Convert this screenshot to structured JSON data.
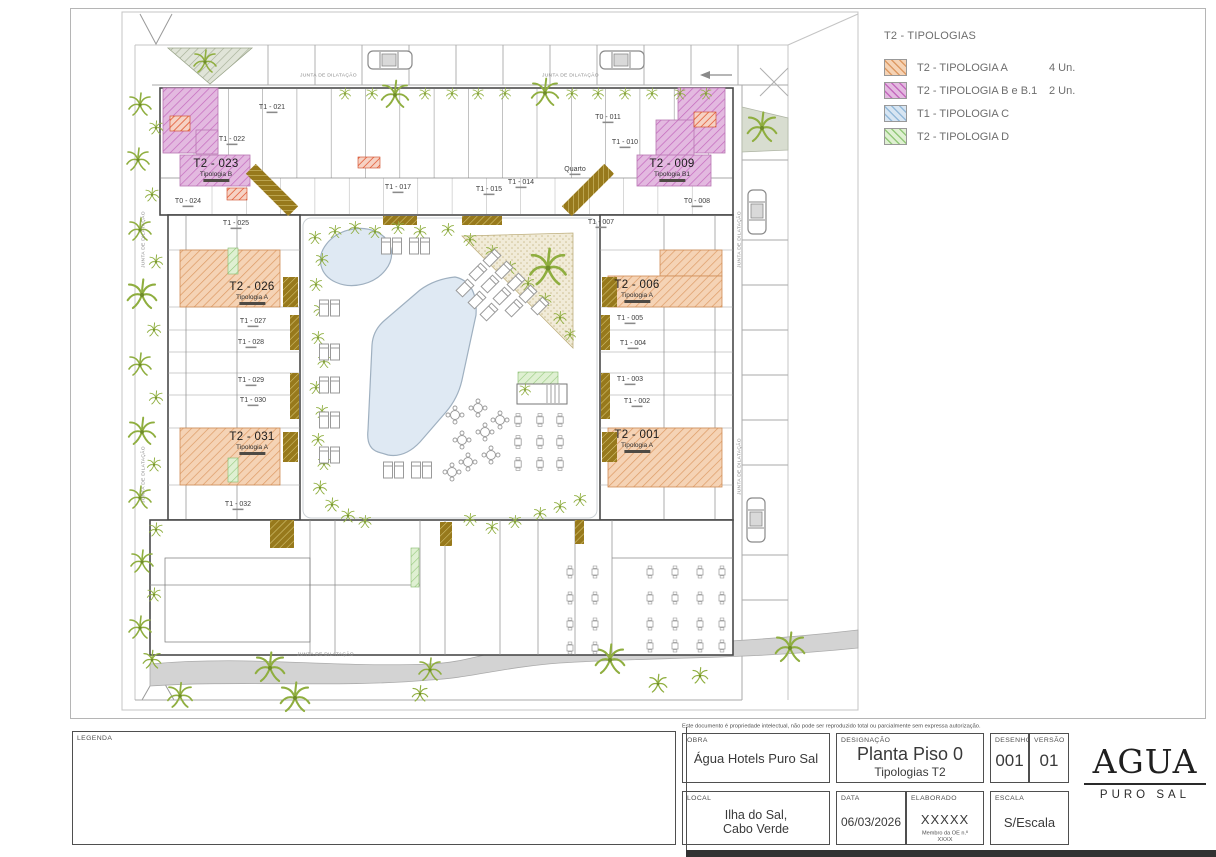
{
  "legend": {
    "title": "T2 - TIPOLOGIAS",
    "items": [
      {
        "label": "T2 - TIPOLOGIA A",
        "count": "4 Un.",
        "color": "#f5d3b5",
        "hatch": "#dd9a64"
      },
      {
        "label": "T2 - TIPOLOGIA B e B.1",
        "count": "2 Un.",
        "color": "#e3b9e0",
        "hatch": "#c468bd"
      },
      {
        "label": "T1 - TIPOLOGIA C",
        "count": "",
        "color": "#d7e5f2",
        "hatch": "#93b9d9"
      },
      {
        "label": "T2 - TIPOLOGIA D",
        "count": "",
        "color": "#dff0d2",
        "hatch": "#93c87a"
      }
    ]
  },
  "plan": {
    "junta_label": "JUNTA DE DILATAÇÃO",
    "units": [
      {
        "id": "T2 - 023",
        "tip": "Tipologia B",
        "x": 216,
        "y": 158
      },
      {
        "id": "T2 - 009",
        "tip": "Tipologia B1",
        "x": 672,
        "y": 158
      },
      {
        "id": "T2 - 026",
        "tip": "Tipologia A",
        "x": 252,
        "y": 281
      },
      {
        "id": "T2 - 006",
        "tip": "Tipologia A",
        "x": 637,
        "y": 279
      },
      {
        "id": "T2 - 031",
        "tip": "Tipologia A",
        "x": 252,
        "y": 431
      },
      {
        "id": "T2 - 001",
        "tip": "Tipologia A",
        "x": 637,
        "y": 429
      }
    ],
    "rooms": [
      {
        "id": "T1 - 021",
        "x": 272,
        "y": 103
      },
      {
        "id": "T1 - 022",
        "x": 232,
        "y": 135
      },
      {
        "id": "T0 - 024",
        "x": 188,
        "y": 197
      },
      {
        "id": "T1 - 025",
        "x": 236,
        "y": 219
      },
      {
        "id": "T1 - 027",
        "x": 253,
        "y": 317
      },
      {
        "id": "T1 - 028",
        "x": 251,
        "y": 338
      },
      {
        "id": "T1 - 029",
        "x": 251,
        "y": 376
      },
      {
        "id": "T1 - 030",
        "x": 253,
        "y": 396
      },
      {
        "id": "T1 - 032",
        "x": 238,
        "y": 500
      },
      {
        "id": "T0 - 011",
        "x": 608,
        "y": 113
      },
      {
        "id": "T1 - 010",
        "x": 625,
        "y": 138
      },
      {
        "id": "T0 - 008",
        "x": 697,
        "y": 197
      },
      {
        "id": "T1 - 007",
        "x": 601,
        "y": 218
      },
      {
        "id": "T1 - 005",
        "x": 630,
        "y": 314
      },
      {
        "id": "T1 - 004",
        "x": 633,
        "y": 339
      },
      {
        "id": "T1 - 003",
        "x": 630,
        "y": 375
      },
      {
        "id": "T1 - 002",
        "x": 637,
        "y": 397
      },
      {
        "id": "T1 - 017",
        "x": 398,
        "y": 183
      },
      {
        "id": "T1 - 015",
        "x": 489,
        "y": 185
      },
      {
        "id": "T1 - 014",
        "x": 521,
        "y": 178
      },
      {
        "id": "Quarto",
        "x": 575,
        "y": 165
      }
    ]
  },
  "titleblock": {
    "copyright": "Este documento é propriedade intelectual, não pode ser reproduzido total ou parcialmente sem expressa autorização.",
    "legenda_label": "LEGENDA",
    "obra": {
      "label": "OBRA",
      "value": "Água Hotels Puro Sal"
    },
    "designacao": {
      "label": "DESIGNAÇÃO",
      "value": "Planta Piso 0",
      "subvalue": "Tipologias T2"
    },
    "desenho": {
      "label": "DESENHO",
      "value": "001"
    },
    "versao": {
      "label": "VERSÃO",
      "value": "01"
    },
    "local": {
      "label": "LOCAL",
      "value": "Ilha do Sal,",
      "value2": "Cabo Verde"
    },
    "data": {
      "label": "DATA",
      "value": "06/03/2026"
    },
    "elaborado": {
      "label": "ELABORADO",
      "value": "XXXXX",
      "note": "Membro da OE n.º XXXX"
    },
    "escala": {
      "label": "ESCALA",
      "value": "S/Escala"
    },
    "logo": {
      "name": "AGUA",
      "sub": "PURO SAL"
    }
  }
}
